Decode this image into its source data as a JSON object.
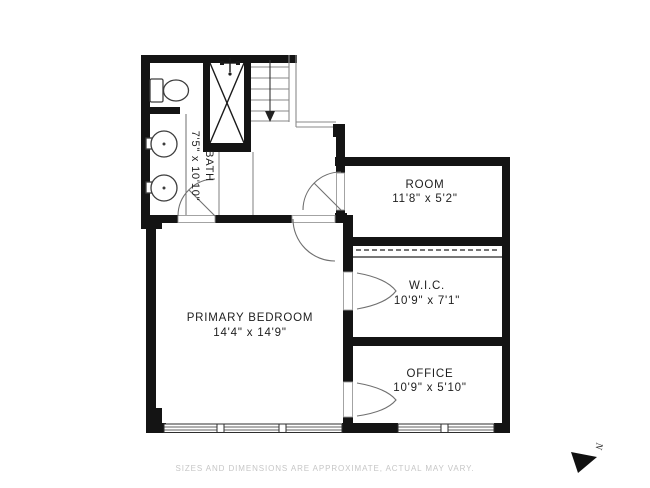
{
  "plan": {
    "rooms": {
      "bath": {
        "name": "BATH",
        "dims": "7'5\" x 10'10\""
      },
      "room": {
        "name": "ROOM",
        "dims": "11'8\" x 5'2\""
      },
      "wic": {
        "name": "W.I.C.",
        "dims": "10'9\" x 7'1\""
      },
      "office": {
        "name": "OFFICE",
        "dims": "10'9\" x 5'10\""
      },
      "primary_bedroom": {
        "name": "PRIMARY BEDROOM",
        "dims": "14'4\" x 14'9\""
      }
    },
    "fixtures": [
      "toilet-icon",
      "sink-icon",
      "sink-icon",
      "shower-icon",
      "stairs-down-icon"
    ],
    "colors": {
      "wall": "#141414",
      "stair_line": "#8a8a8a",
      "label_text": "#1e1e1e",
      "muted_text": "#c6c6c6"
    }
  },
  "compass": {
    "label": "N"
  },
  "footer": {
    "disclaimer": "SIZES AND DIMENSIONS ARE APPROXIMATE, ACTUAL MAY VARY."
  }
}
